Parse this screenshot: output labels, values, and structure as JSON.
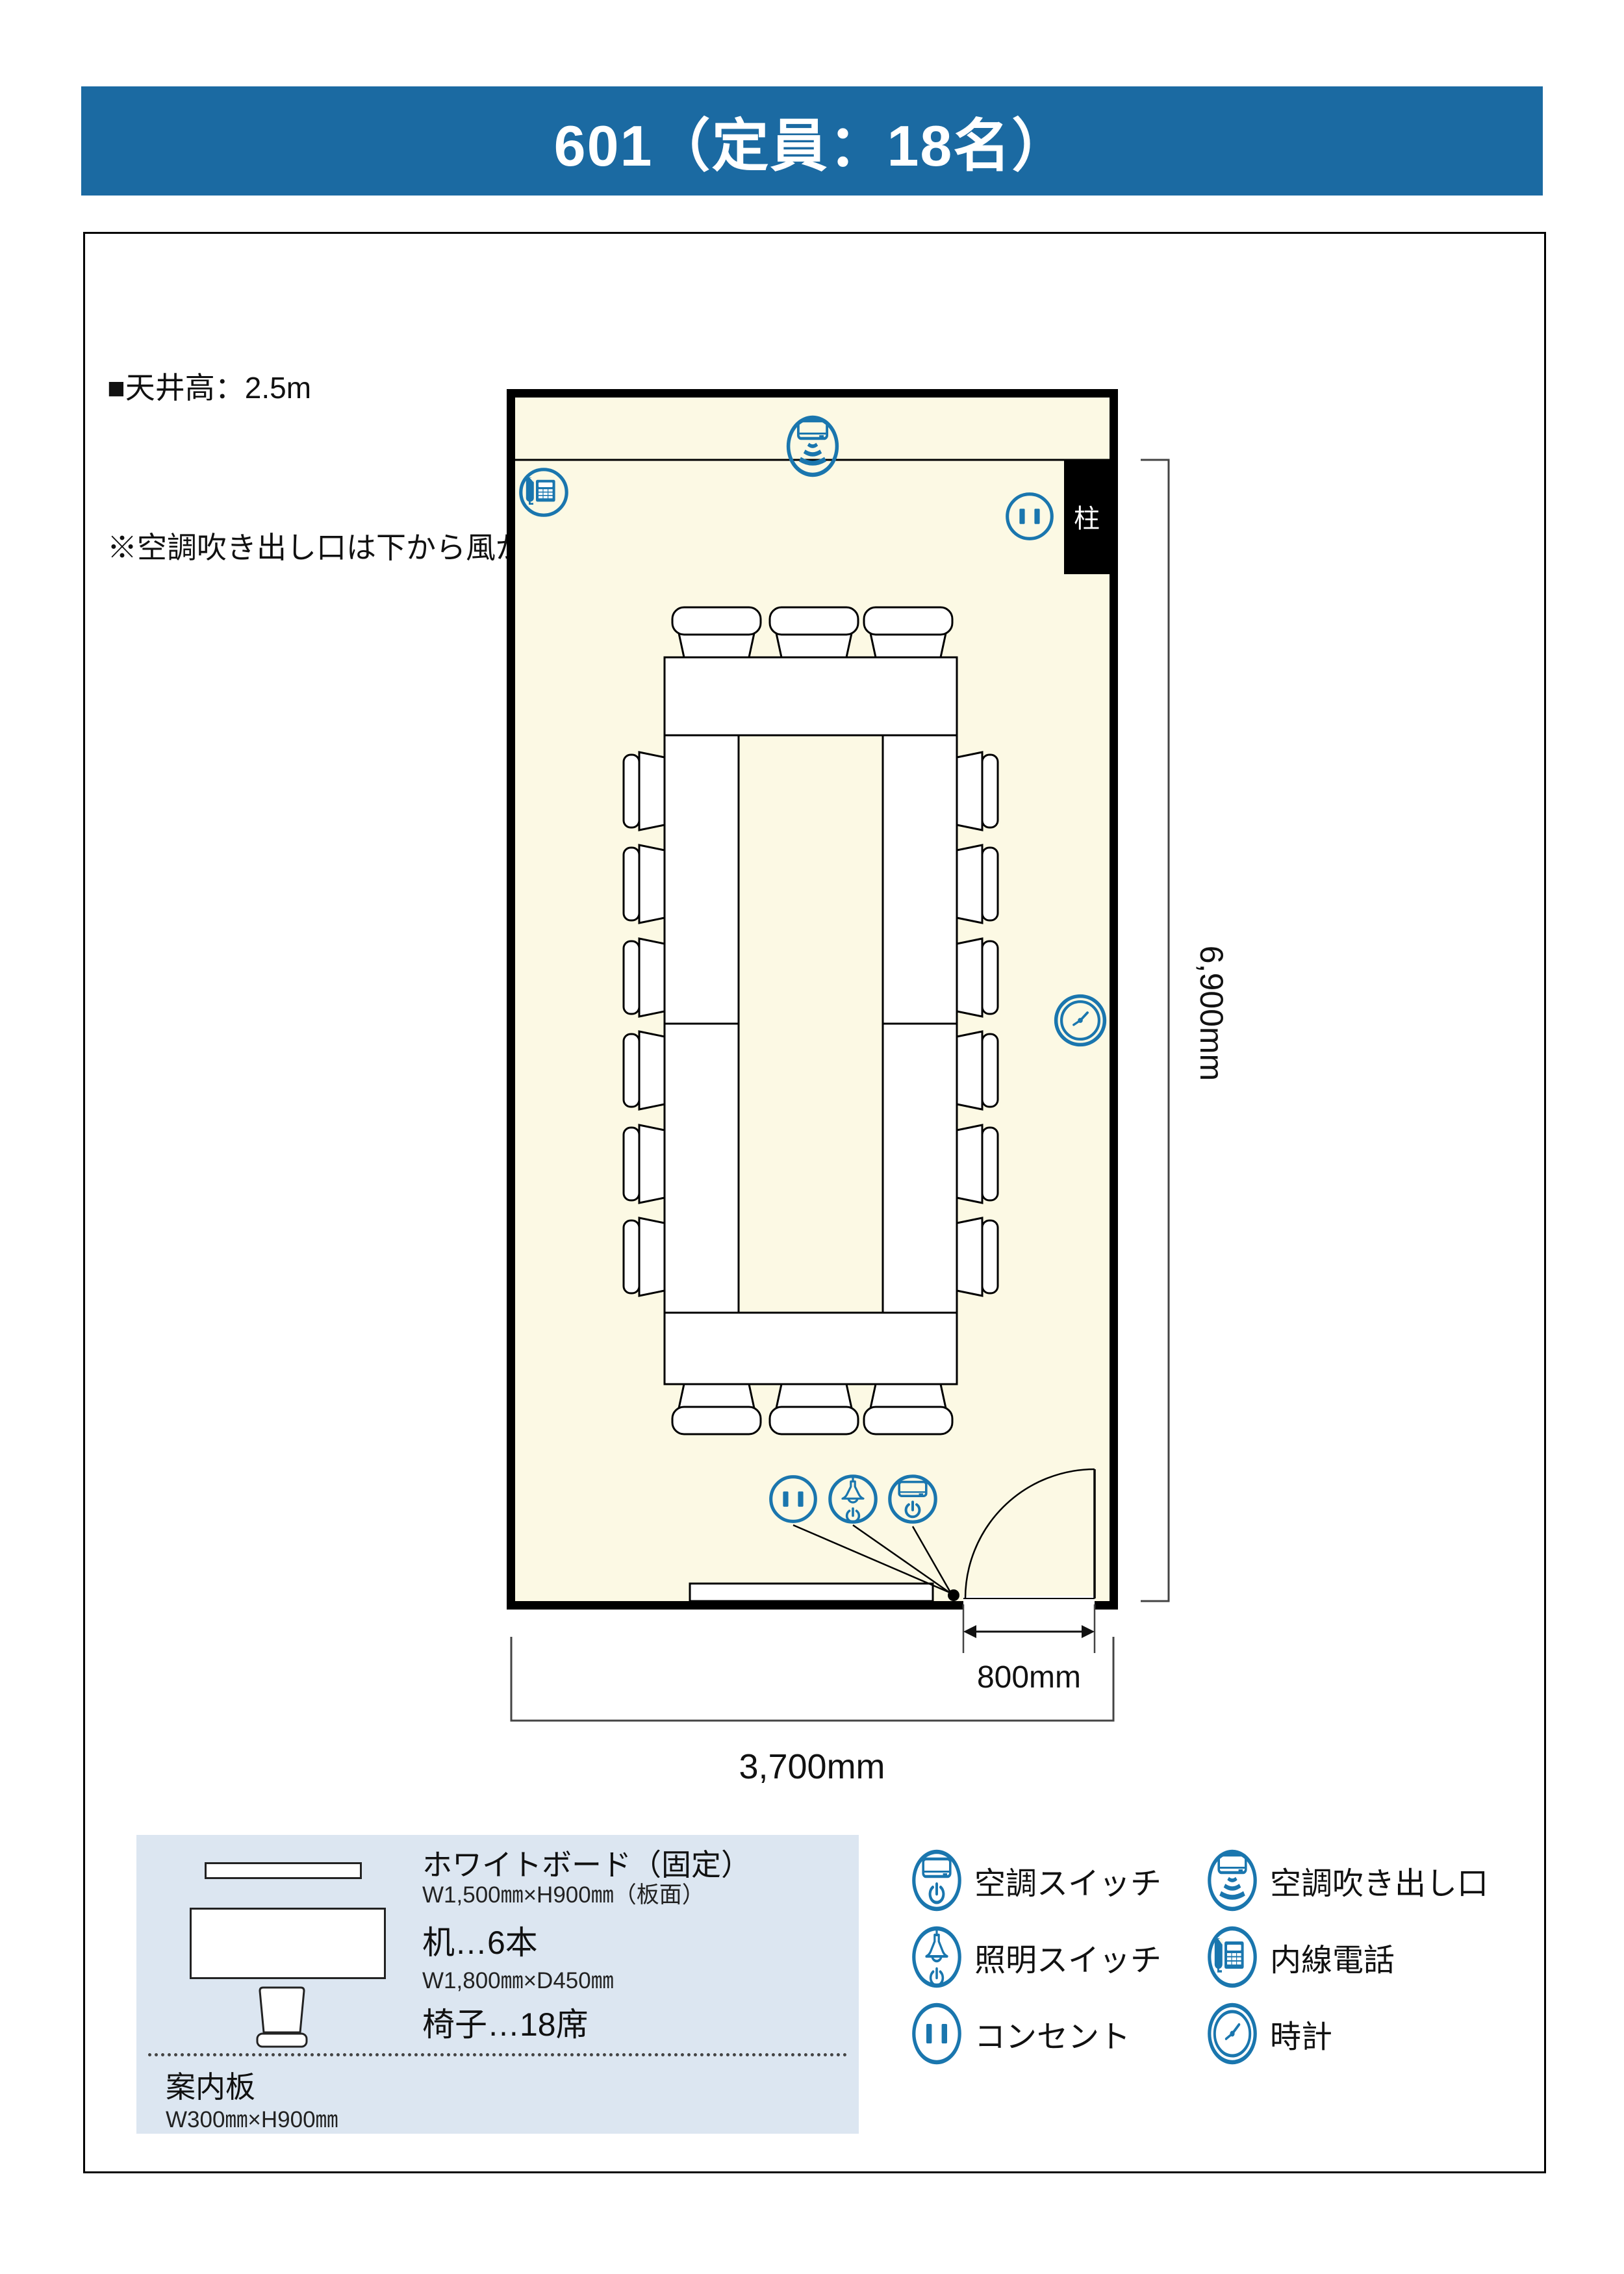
{
  "page": {
    "title": "601（定員：18名）"
  },
  "notes": [
    "■天井高：2.5m",
    "※空調吹き出し口は下から風がきます"
  ],
  "room": {
    "pillar_label": "柱",
    "dimensions": {
      "length": "6,900mm",
      "width": "3,700mm",
      "door": "800mm"
    }
  },
  "plan": {
    "icons": [
      "ac-vent-icon",
      "phone-icon",
      "outlet-icon",
      "clock-icon",
      "outlet-icon",
      "light-switch-icon",
      "ac-switch-icon"
    ]
  },
  "furniture_legend": {
    "whiteboard": {
      "icon": "whiteboard-shape",
      "name": "ホワイトボード（固定）",
      "size": "W1,500㎜×H900㎜（板面）"
    },
    "desk": {
      "icon": "desk-shape",
      "name": "机…6本",
      "size": "W1,800㎜×D450㎜"
    },
    "chair": {
      "icon": "chair-shape",
      "name": "椅子…18席"
    },
    "sign": {
      "name": "案内板",
      "size": "W300㎜×H900㎜"
    }
  },
  "equipment_legend": {
    "items": [
      {
        "icon": "ac-switch-icon",
        "label": "空調スイッチ"
      },
      {
        "icon": "ac-vent-icon",
        "label": "空調吹き出し口"
      },
      {
        "icon": "light-switch-icon",
        "label": "照明スイッチ"
      },
      {
        "icon": "phone-icon",
        "label": "内線電話"
      },
      {
        "icon": "outlet-icon",
        "label": "コンセント"
      },
      {
        "icon": "clock-icon",
        "label": "時計"
      }
    ]
  },
  "colors": {
    "accent_blue": "#1A76AE",
    "title_bar": "#1B6AA2",
    "floor": "#FCF9E4",
    "legend_bg": "#DCE6F1",
    "wall": "#000000"
  }
}
